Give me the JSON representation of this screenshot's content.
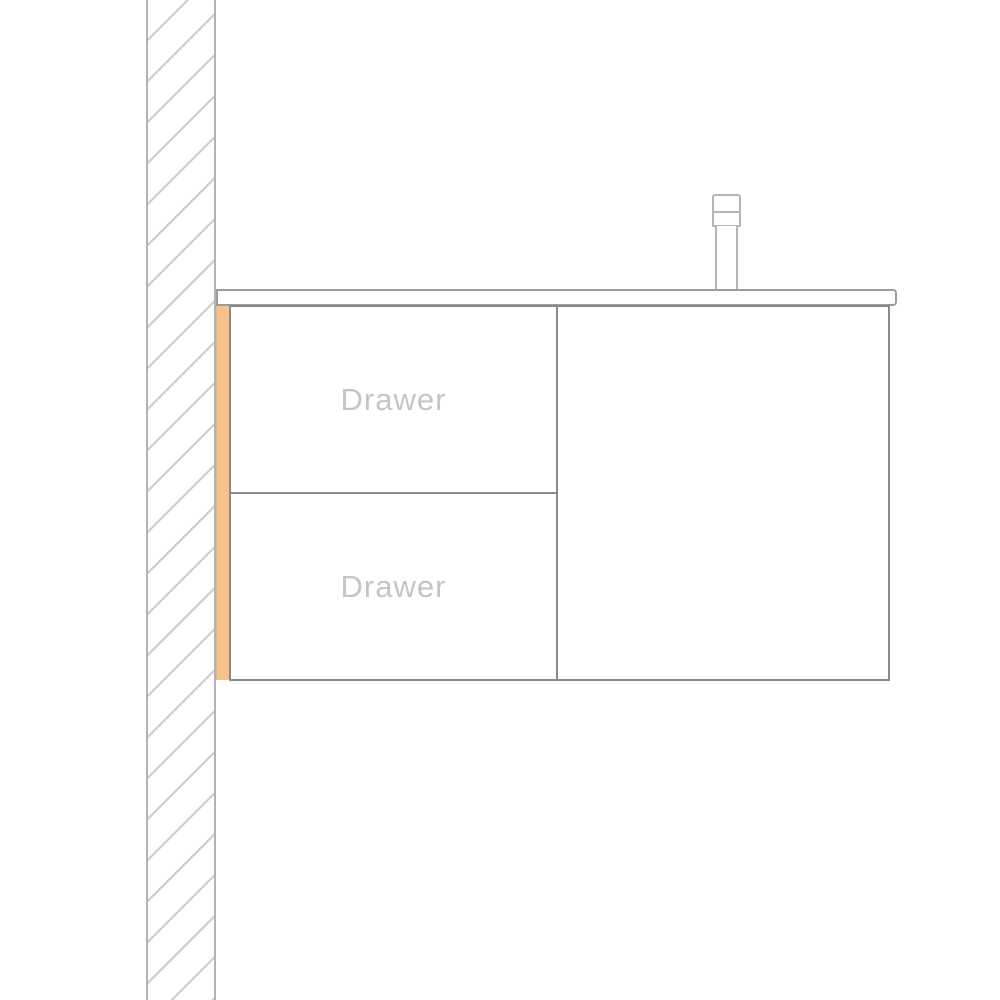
{
  "diagram": {
    "cabinet": {
      "drawers": [
        {
          "label": "Drawer"
        },
        {
          "label": "Drawer"
        }
      ]
    },
    "colors": {
      "background": "#ffffff",
      "cabinet_outline": "#8a8a8a",
      "countertop_outline": "#9c9c9c",
      "faucet_outline": "#b5b5b5",
      "wall_border": "#b3b3b3",
      "wall_hatch": "#cdcdcd",
      "mount_strip_accent": "#f7c18b",
      "label_text": "#c5c5c5"
    }
  }
}
